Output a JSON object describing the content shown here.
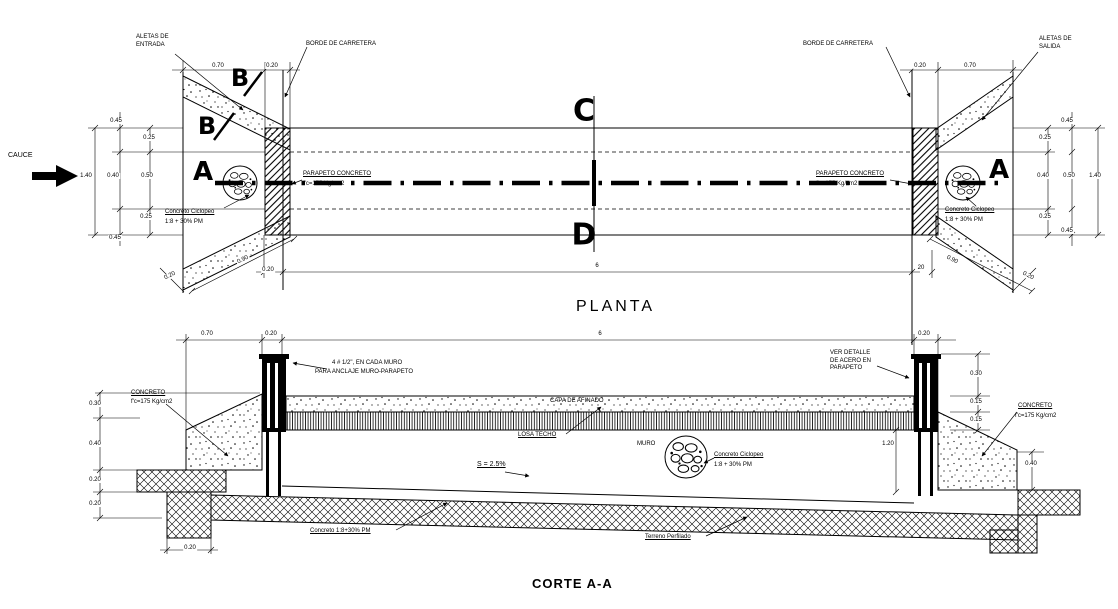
{
  "titles": {
    "plan": "PLANTA",
    "section": "CORTE A-A"
  },
  "colors": {
    "ink": "#000000",
    "paper": "#ffffff"
  },
  "plan": {
    "labels": [
      {
        "n": "cauce-label",
        "t": "CAUCE",
        "x": 8,
        "y": 152,
        "fs": 7
      },
      {
        "n": "aletas-entrada-label",
        "t": "ALETAS DE\nENTRADA",
        "x": 136,
        "y": 34,
        "fs": 6
      },
      {
        "n": "borde-carretera-left-label",
        "t": "BORDE DE CARRETERA",
        "x": 306,
        "y": 41,
        "fs": 6
      },
      {
        "n": "parapeto-left-label",
        "t": "PARAPETO CONCRETO",
        "x": 303,
        "y": 171,
        "fs": 6,
        "u": 1
      },
      {
        "n": "parapeto-left-spec",
        "t": "f'c=175 Kg/cm2",
        "x": 303,
        "y": 181,
        "fs": 6
      },
      {
        "n": "ciclopeo-left-label",
        "t": "Concreto Ciclopeo",
        "x": 165,
        "y": 209,
        "fs": 6,
        "u": 1
      },
      {
        "n": "ciclopeo-left-spec",
        "t": "1:8 + 30% PM",
        "x": 165,
        "y": 219,
        "fs": 6
      },
      {
        "n": "borde-carretera-right-label",
        "t": "BORDE DE CARRETERA",
        "x": 803,
        "y": 41,
        "fs": 6
      },
      {
        "n": "aletas-salida-label",
        "t": "ALETAS DE\nSALIDA",
        "x": 1039,
        "y": 36,
        "fs": 6
      },
      {
        "n": "parapeto-right-label",
        "t": "PARAPETO CONCRETO",
        "x": 816,
        "y": 171,
        "fs": 6,
        "u": 1
      },
      {
        "n": "parapeto-right-spec",
        "t": "f'c=175 Kg/cm2",
        "x": 816,
        "y": 181,
        "fs": 6
      },
      {
        "n": "ciclopeo-right-label",
        "t": "Concreto Ciclopeo",
        "x": 945,
        "y": 207,
        "fs": 6,
        "u": 1
      },
      {
        "n": "ciclopeo-right-spec",
        "t": "1:8 + 30% PM",
        "x": 945,
        "y": 217,
        "fs": 6
      }
    ],
    "markers": [
      {
        "n": "section-marker-b-top",
        "t": "B",
        "x": 240,
        "y": 78,
        "fs": 24,
        "c": 1
      },
      {
        "n": "section-marker-b-mid",
        "t": "B",
        "x": 207,
        "y": 126,
        "fs": 24,
        "c": 1
      },
      {
        "n": "section-marker-a-left",
        "t": "A",
        "x": 203,
        "y": 172,
        "fs": 26,
        "c": 1
      },
      {
        "n": "section-marker-a-right",
        "t": "A",
        "x": 999,
        "y": 170,
        "fs": 26,
        "c": 1
      },
      {
        "n": "section-marker-c",
        "t": "C",
        "x": 584,
        "y": 111,
        "fs": 30,
        "c": 1
      },
      {
        "n": "section-marker-d",
        "t": "D",
        "x": 584,
        "y": 235,
        "fs": 30,
        "c": 1
      }
    ],
    "dims": [
      {
        "n": "dim",
        "t": "0.70",
        "x": 218,
        "y": 66,
        "c": 1
      },
      {
        "n": "dim",
        "t": "0.20",
        "x": 272,
        "y": 66,
        "c": 1
      },
      {
        "n": "dim",
        "t": "0.20",
        "x": 920,
        "y": 66,
        "c": 1
      },
      {
        "n": "dim",
        "t": "0.70",
        "x": 970,
        "y": 66,
        "c": 1
      },
      {
        "n": "dim",
        "t": "1.40",
        "x": 86,
        "y": 176,
        "c": 1
      },
      {
        "n": "dim",
        "t": "0.40",
        "x": 113,
        "y": 176,
        "c": 1
      },
      {
        "n": "dim",
        "t": "0.50",
        "x": 147,
        "y": 176,
        "c": 1
      },
      {
        "n": "dim",
        "t": "0.45",
        "x": 116,
        "y": 121,
        "c": 1
      },
      {
        "n": "dim",
        "t": "0.25",
        "x": 149,
        "y": 138,
        "c": 1
      },
      {
        "n": "dim",
        "t": "0.25",
        "x": 146,
        "y": 217,
        "c": 1
      },
      {
        "n": "dim",
        "t": "0.45",
        "x": 115,
        "y": 238,
        "c": 1
      },
      {
        "n": "dim",
        "t": "0.40",
        "x": 1043,
        "y": 176,
        "c": 1
      },
      {
        "n": "dim",
        "t": "0.50",
        "x": 1069,
        "y": 176,
        "c": 1
      },
      {
        "n": "dim",
        "t": "1.40",
        "x": 1095,
        "y": 176,
        "c": 1
      },
      {
        "n": "dim",
        "t": "0.45",
        "x": 1067,
        "y": 121,
        "c": 1
      },
      {
        "n": "dim",
        "t": "0.25",
        "x": 1045,
        "y": 138,
        "c": 1
      },
      {
        "n": "dim",
        "t": "0.25",
        "x": 1045,
        "y": 217,
        "c": 1
      },
      {
        "n": "dim",
        "t": "0.45",
        "x": 1067,
        "y": 231,
        "c": 1
      },
      {
        "n": "dim",
        "t": "0.90",
        "x": 243,
        "y": 260,
        "c": 1,
        "r": -27
      },
      {
        "n": "dim",
        "t": "0.20",
        "x": 170,
        "y": 276,
        "c": 1,
        "r": -27
      },
      {
        "n": "dim",
        "t": "0.90",
        "x": 952,
        "y": 260,
        "c": 1,
        "r": 27
      },
      {
        "n": "dim",
        "t": "0.20",
        "x": 1028,
        "y": 276,
        "c": 1,
        "r": 27
      },
      {
        "n": "dim",
        "t": "0.20",
        "x": 268,
        "y": 270,
        "c": 1
      },
      {
        "n": "dim",
        "t": "6",
        "x": 597,
        "y": 266,
        "c": 1
      },
      {
        "n": "dim",
        "t": "20",
        "x": 921,
        "y": 268,
        "c": 1
      }
    ]
  },
  "section": {
    "labels": [
      {
        "n": "anclaje-label",
        "t": "4 # 1/2\", EN CADA MURO",
        "x": 332,
        "y": 360,
        "fs": 6
      },
      {
        "n": "anclaje-spec",
        "t": "PARA ANCLAJE MURO-PARAPETO",
        "x": 315,
        "y": 369,
        "fs": 6
      },
      {
        "n": "concreto-left-label",
        "t": "CONCRETO",
        "x": 131,
        "y": 390,
        "fs": 6,
        "u": 1
      },
      {
        "n": "concreto-left-spec",
        "t": "f'c=175 Kg/cm2",
        "x": 131,
        "y": 399,
        "fs": 6
      },
      {
        "n": "capa-afinado-label",
        "t": "CAPA DE AFINADO",
        "x": 550,
        "y": 398,
        "fs": 6
      },
      {
        "n": "losa-techo-label",
        "t": "LOSA TECHO",
        "x": 518,
        "y": 432,
        "fs": 6,
        "u": 1
      },
      {
        "n": "muro-label",
        "t": "MURO",
        "x": 637,
        "y": 441,
        "fs": 6
      },
      {
        "n": "ciclopeo-section-label",
        "t": "Concreto Ciclopeo",
        "x": 714,
        "y": 452,
        "fs": 6,
        "u": 1
      },
      {
        "n": "ciclopeo-section-spec",
        "t": "1:8 + 30% PM",
        "x": 714,
        "y": 462,
        "fs": 6
      },
      {
        "n": "pendiente-label",
        "t": "S = 2.5%",
        "x": 477,
        "y": 461,
        "fs": 7,
        "u": 1
      },
      {
        "n": "ver-detalle-label",
        "t": "VER DETALLE\nDE ACERO EN\nPARAPETO",
        "x": 830,
        "y": 350,
        "fs": 6
      },
      {
        "n": "concreto-right-label",
        "t": "CONCRETO",
        "x": 1018,
        "y": 403,
        "fs": 6,
        "u": 1
      },
      {
        "n": "concreto-right-spec",
        "t": "f'c=175 Kg/cm2",
        "x": 1015,
        "y": 413,
        "fs": 6
      },
      {
        "n": "concreto-base-label",
        "t": "Concreto 1:8+30% PM",
        "x": 310,
        "y": 528,
        "fs": 6,
        "u": 1
      },
      {
        "n": "terreno-label",
        "t": "Terreno Perfilado",
        "x": 645,
        "y": 534,
        "fs": 6,
        "u": 1
      }
    ],
    "dims": [
      {
        "n": "dim",
        "t": "0.70",
        "x": 207,
        "y": 334,
        "c": 1
      },
      {
        "n": "dim",
        "t": "0.20",
        "x": 271,
        "y": 334,
        "c": 1
      },
      {
        "n": "dim",
        "t": "6",
        "x": 600,
        "y": 334,
        "c": 1
      },
      {
        "n": "dim",
        "t": "0.20",
        "x": 924,
        "y": 334,
        "c": 1
      },
      {
        "n": "dim",
        "t": "0.30",
        "x": 95,
        "y": 404,
        "c": 1
      },
      {
        "n": "dim",
        "t": "0.40",
        "x": 95,
        "y": 444,
        "c": 1
      },
      {
        "n": "dim",
        "t": "0.20",
        "x": 95,
        "y": 480,
        "c": 1
      },
      {
        "n": "dim",
        "t": "0.20",
        "x": 95,
        "y": 504,
        "c": 1
      },
      {
        "n": "dim",
        "t": "0.20",
        "x": 190,
        "y": 548,
        "c": 1
      },
      {
        "n": "dim",
        "t": "0.30",
        "x": 976,
        "y": 374,
        "c": 1
      },
      {
        "n": "dim",
        "t": "0.15",
        "x": 976,
        "y": 402,
        "c": 1
      },
      {
        "n": "dim",
        "t": "0.15",
        "x": 976,
        "y": 420,
        "c": 1
      },
      {
        "n": "dim",
        "t": "1.20",
        "x": 888,
        "y": 444,
        "c": 1
      },
      {
        "n": "dim",
        "t": "0.40",
        "x": 1031,
        "y": 464,
        "c": 1
      }
    ]
  }
}
